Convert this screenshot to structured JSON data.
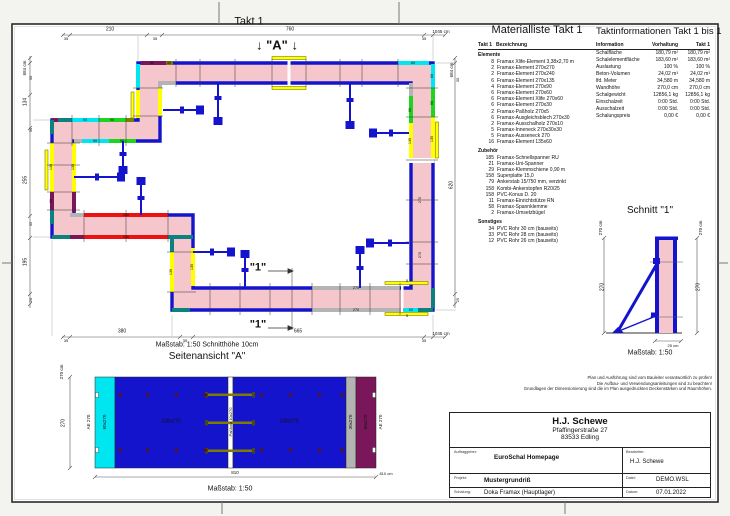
{
  "colors": {
    "wall_pink": "#f6c6cd",
    "element_blue": "#1414cc",
    "cyan": "#00e6f0",
    "green": "#1ed41e",
    "yellow": "#ffff00",
    "magenta": "#7a175a",
    "red": "#ee1111",
    "teal": "#0d8080",
    "gray": "#b4b4b4",
    "olive": "#7d7d00",
    "tie_dark": "#5c1212"
  },
  "plan": {
    "title": "Takt 1",
    "section_marker": "↓ \"A\" ↓",
    "cut_marker": "\"1\"",
    "scale_note": "Maßstab: 1:50   Schnitthöhe 10cm",
    "dim_labels": [
      {
        "t": "210",
        "x": 110,
        "y": 30
      },
      {
        "t": "760",
        "x": 290,
        "y": 30
      },
      {
        "t": "35",
        "x": 66,
        "y": 39,
        "s": 4
      },
      {
        "t": "35",
        "x": 155,
        "y": 39,
        "s": 4
      },
      {
        "t": "35",
        "x": 424,
        "y": 39,
        "s": 4
      },
      {
        "t": "1045 cm",
        "x": 441,
        "y": 32,
        "s": 4.5
      },
      {
        "t": "684 cm",
        "x": 25,
        "y": 68,
        "r": 1,
        "s": 4.5
      },
      {
        "t": "30",
        "x": 31,
        "y": 78,
        "r": 1,
        "s": 4
      },
      {
        "t": "134",
        "x": 26,
        "y": 102,
        "r": 1
      },
      {
        "t": "30",
        "x": 31,
        "y": 130,
        "r": 1,
        "s": 4
      },
      {
        "t": "255",
        "x": 26,
        "y": 180,
        "r": 1
      },
      {
        "t": "35",
        "x": 31,
        "y": 224,
        "r": 1,
        "s": 4
      },
      {
        "t": "195",
        "x": 26,
        "y": 262,
        "r": 1
      },
      {
        "t": "20",
        "x": 31,
        "y": 300,
        "r": 1,
        "s": 4
      },
      {
        "t": "684 cm",
        "x": 452,
        "y": 70,
        "r": 1,
        "s": 4.5
      },
      {
        "t": "30",
        "x": 458,
        "y": 80,
        "r": 1,
        "s": 4
      },
      {
        "t": "620",
        "x": 452,
        "y": 185,
        "r": 1
      },
      {
        "t": "25",
        "x": 458,
        "y": 300,
        "r": 1,
        "s": 4
      },
      {
        "t": "380",
        "x": 122,
        "y": 332
      },
      {
        "t": "665",
        "x": 298,
        "y": 332
      },
      {
        "t": "35",
        "x": 66,
        "y": 341,
        "s": 4
      },
      {
        "t": "35",
        "x": 185,
        "y": 341,
        "s": 4
      },
      {
        "t": "35",
        "x": 424,
        "y": 341,
        "s": 4
      },
      {
        "t": "1045 cm",
        "x": 441,
        "y": 334,
        "s": 4.5
      }
    ],
    "element_labels": [
      {
        "t": "60",
        "x": 152,
        "y": 63.5
      },
      {
        "t": "30",
        "x": 169,
        "y": 63.5
      },
      {
        "t": "60",
        "x": 413,
        "y": 63.5
      },
      {
        "t": "90",
        "x": 85,
        "y": 120.5
      },
      {
        "t": "90",
        "x": 112,
        "y": 120.5
      },
      {
        "t": "90",
        "x": 95,
        "y": 141.5
      },
      {
        "t": "90",
        "x": 122,
        "y": 141.5
      },
      {
        "t": "135",
        "x": 52,
        "y": 167,
        "r": 1
      },
      {
        "t": "135",
        "x": 74,
        "y": 167,
        "r": 1
      },
      {
        "t": "60",
        "x": 52,
        "y": 201,
        "r": 1
      },
      {
        "t": "240",
        "x": 126,
        "y": 215.5
      },
      {
        "t": "240",
        "x": 126,
        "y": 237.5
      },
      {
        "t": "135",
        "x": 172,
        "y": 272,
        "r": 1
      },
      {
        "t": "135",
        "x": 193,
        "y": 267,
        "r": 1
      },
      {
        "t": "270",
        "x": 356,
        "y": 288.5
      },
      {
        "t": "270",
        "x": 356,
        "y": 310.5
      },
      {
        "t": "60",
        "x": 411,
        "y": 310.5
      },
      {
        "t": "5",
        "x": 407,
        "y": 281,
        "s": 4
      },
      {
        "t": "5",
        "x": 407,
        "y": 316,
        "s": 4
      },
      {
        "t": "60",
        "x": 433,
        "y": 76,
        "r": 1
      },
      {
        "t": "90",
        "x": 433,
        "y": 103,
        "r": 1
      },
      {
        "t": "135",
        "x": 433,
        "y": 139,
        "r": 1
      },
      {
        "t": "270",
        "x": 421,
        "y": 200,
        "r": 1
      },
      {
        "t": "270",
        "x": 421,
        "y": 255,
        "r": 1
      },
      {
        "t": "90",
        "x": 411,
        "y": 110,
        "r": 1
      },
      {
        "t": "135",
        "x": 411,
        "y": 141,
        "r": 1
      }
    ]
  },
  "seitenansicht": {
    "title": "Seitenansicht \"A\"",
    "scale": "Maßstab: 1:50",
    "labels": [
      {
        "t": "270 cm",
        "x": 62,
        "y": 372,
        "r": 1,
        "s": 4.5
      },
      {
        "t": "270",
        "x": 64,
        "y": 423,
        "r": 1
      },
      {
        "t": "AE 270",
        "x": 89,
        "y": 422,
        "r": 1,
        "s": 4.5
      },
      {
        "t": "60x270",
        "x": 105,
        "y": 422,
        "r": 1,
        "s": 4.5
      },
      {
        "t": "338x270",
        "x": 171,
        "y": 422,
        "s": 5
      },
      {
        "t": "Paßholz 10x270",
        "x": 230.5,
        "y": 422,
        "r": 1,
        "s": 4
      },
      {
        "t": "338x270",
        "x": 289,
        "y": 422,
        "s": 5
      },
      {
        "t": "30x270",
        "x": 351,
        "y": 422,
        "r": 1,
        "s": 4.5
      },
      {
        "t": "60x270",
        "x": 366,
        "y": 422,
        "r": 1,
        "s": 4.5
      },
      {
        "t": "AE 270",
        "x": 381,
        "y": 422,
        "r": 1,
        "s": 4.5
      },
      {
        "t": "810",
        "x": 235,
        "y": 473,
        "s": 4.5
      },
      {
        "t": "810 cm",
        "x": 386,
        "y": 474,
        "s": 4
      }
    ]
  },
  "schnitt": {
    "title": "Schnitt \"1\"",
    "scale": "Maßstab: 1:50",
    "labels": [
      {
        "t": "270 cm",
        "x": 601,
        "y": 228,
        "r": 1,
        "s": 4.5
      },
      {
        "t": "270",
        "x": 603,
        "y": 287,
        "r": 1
      },
      {
        "t": "270 cm",
        "x": 701,
        "y": 228,
        "r": 1,
        "s": 4.5
      },
      {
        "t": "270",
        "x": 699,
        "y": 287,
        "r": 1
      },
      {
        "t": "25 cm",
        "x": 673,
        "y": 346,
        "s": 4
      }
    ]
  },
  "materialliste": {
    "title": "Materialliste  Takt 1",
    "header": {
      "col1": "Takt 1",
      "col2": "Bezeichnung"
    },
    "sections": [
      {
        "name": "Elemente",
        "items": [
          {
            "qty": "8",
            "desc": "Framax Xlife-Element 3,38x2,70 m"
          },
          {
            "qty": "2",
            "desc": "Framax-Element 270x270"
          },
          {
            "qty": "2",
            "desc": "Framax-Element 270x240"
          },
          {
            "qty": "6",
            "desc": "Framax-Element 270x135"
          },
          {
            "qty": "4",
            "desc": "Framax-Element 270x90"
          },
          {
            "qty": "6",
            "desc": "Framax-Element 270x60"
          },
          {
            "qty": "6",
            "desc": "Framax-Element Xlife 270x60"
          },
          {
            "qty": "6",
            "desc": "Framax-Element 270x30"
          },
          {
            "qty": "2",
            "desc": "Framax-Paßholz 270x5"
          },
          {
            "qty": "6",
            "desc": "Framax-Ausgleichsblech 270x30"
          },
          {
            "qty": "2",
            "desc": "Framax-Ausschalholz 270x10"
          },
          {
            "qty": "5",
            "desc": "Framax-Inneneck 270x30x30"
          },
          {
            "qty": "5",
            "desc": "Framax-Ausseneck 270"
          },
          {
            "qty": "16",
            "desc": "Framax-Element 135x60"
          }
        ]
      },
      {
        "name": "Zubehör",
        "items": [
          {
            "qty": "185",
            "desc": "Framax-Schnellspanner RU"
          },
          {
            "qty": "21",
            "desc": "Framax-Uni-Spanner"
          },
          {
            "qty": "29",
            "desc": "Framax-Klemmschiene 0,90 m"
          },
          {
            "qty": "158",
            "desc": "Superplatte 15,0"
          },
          {
            "qty": "79",
            "desc": "Ankerstab 15/750 mm, verzinkt"
          },
          {
            "qty": "158",
            "desc": "Kombi-Ankerstopfen R20/25"
          },
          {
            "qty": "158",
            "desc": "PVC-Konus D. 20"
          },
          {
            "qty": "11",
            "desc": "Framax-Einrichtstütze RN"
          },
          {
            "qty": "58",
            "desc": "Framax-Spannklemme"
          },
          {
            "qty": "2",
            "desc": "Framax-Umsetzbügel"
          }
        ]
      },
      {
        "name": "Sonstiges",
        "items": [
          {
            "qty": "34",
            "desc": "PVC Rohr 30 cm (bauseits)"
          },
          {
            "qty": "33",
            "desc": "PVC Rohr 28 cm (bauseits)"
          },
          {
            "qty": "12",
            "desc": "PVC Rohr 26 cm (bauseits)"
          }
        ]
      }
    ]
  },
  "taktinfo": {
    "title": "Taktinformationen  Takt 1 bis 1",
    "columns": [
      "Information",
      "Vorhaltung",
      "Takt 1"
    ],
    "rows": [
      [
        "Schalfläche",
        "180,79 m²",
        "180,79 m²"
      ],
      [
        "Schalelementfläche",
        "183,60 m²",
        "183,60 m²"
      ],
      [
        "Auslastung",
        "100 %",
        "100 %"
      ],
      [
        "Beton-Volumen",
        "24,02 m³",
        "24,02 m³"
      ],
      [
        "lfd. Meter",
        "34,580 m",
        "34,580 m"
      ],
      [
        "Wandhöhe",
        "270,0 cm",
        "270,0 cm"
      ],
      [
        "Schalgewicht",
        "12856,1 kg",
        "12856,1 kg"
      ],
      [
        "Einschalzeit",
        "0:00 Std.",
        "0:00 Std."
      ],
      [
        "Ausschalzeit",
        "0:00 Std.",
        "0:00 Std."
      ],
      [
        "Schalungspreis",
        "0,00 €",
        "0,00 €"
      ]
    ]
  },
  "disclaimer": {
    "lines": [
      "Plan und Ausführung sind vom Bauleiter verantwortlich zu prüfen!",
      "Die Aufbau- und Verwendungsanleitungen sind zu beachten!",
      "Grundlagen der Dimensionierung sind die im Plan ausgedruckten Deckenstärken und Raumhöhen."
    ]
  },
  "titleblock": {
    "company": "H.J. Schewe",
    "street": "Pfaffingerstraße 27",
    "city": "83533 Edling",
    "auftraggeber_label": "Auftraggeber:",
    "auftraggeber": "EuroSchal Homepage",
    "bearbeiter_label": "Bearbeiter:",
    "bearbeiter": "H.J. Schewe",
    "projekt_label": "Projekt:",
    "projekt": "Mustergrundriß",
    "datei_label": "Datei:",
    "datei": "DEMO.WSL",
    "schalung_label": "Schalung:",
    "schalung": "Doka Framax (Hauptlager)",
    "datum_label": "Datum:",
    "datum": "07.01.2022"
  }
}
